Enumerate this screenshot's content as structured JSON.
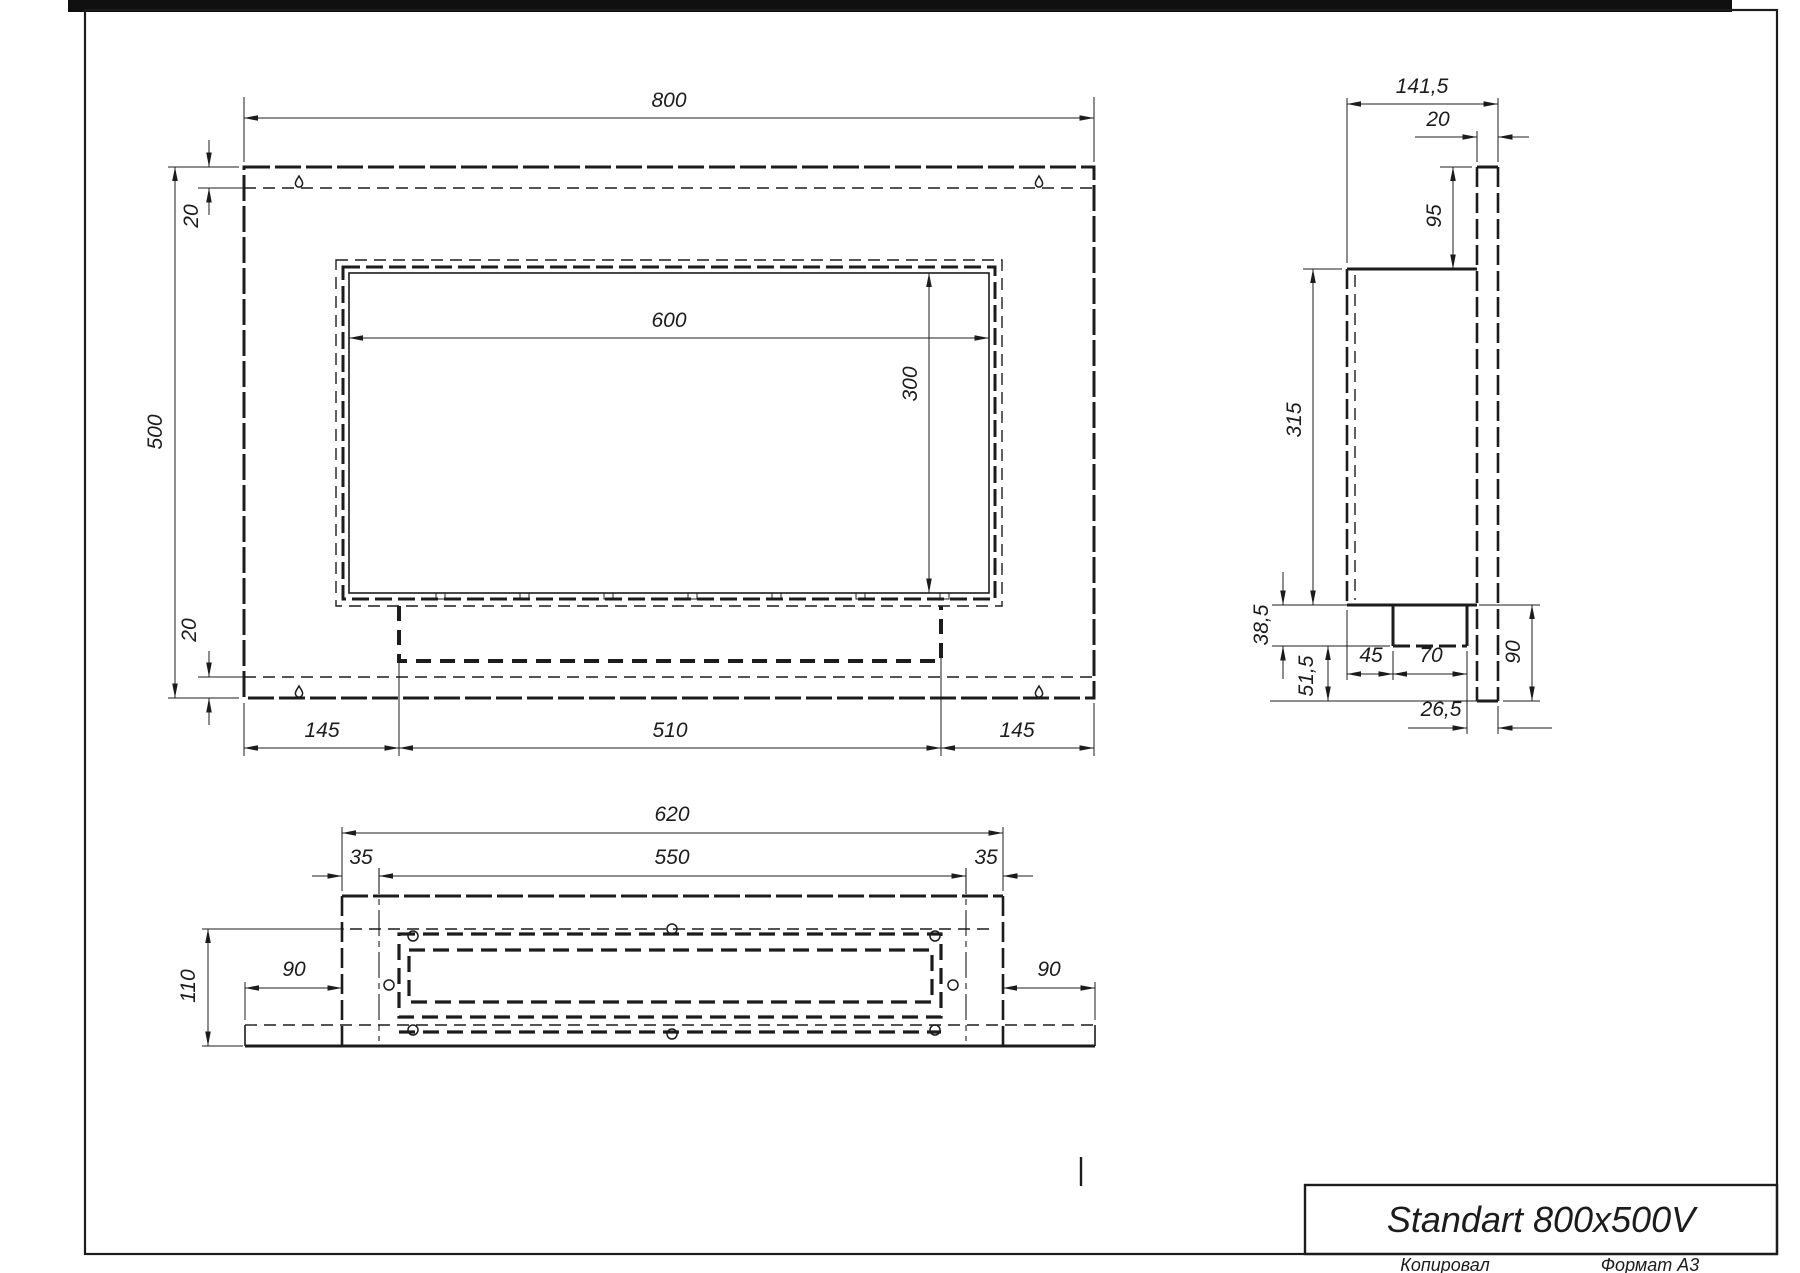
{
  "meta": {
    "drawing_title": "Standart 800x500V",
    "footer_left": "Копировал",
    "footer_right": "Формат A3",
    "line_color": "#1c1c1c"
  },
  "front_view": {
    "dims": {
      "total_width": "800",
      "total_height": "500",
      "top_inset": "20",
      "bottom_inset": "20",
      "opening_width": "600",
      "opening_height": "300",
      "left_offset": "145",
      "burner_width": "510",
      "right_offset": "145"
    }
  },
  "side_view": {
    "dims": {
      "total_depth": "141,5",
      "plate_thickness": "20",
      "top_to_box": "95",
      "box_height": "315",
      "tray_drop": "38,5",
      "tray_to_bottom": "51,5",
      "front_to_tray": "45",
      "tray_depth": "70",
      "tray_to_plate": "26,5",
      "below_box": "90"
    }
  },
  "bottom_view": {
    "dims": {
      "box_width": "620",
      "mount_width": "550",
      "left_inset": "35",
      "right_inset": "35",
      "depth": "110",
      "left_overhang": "90",
      "right_overhang": "90"
    }
  }
}
